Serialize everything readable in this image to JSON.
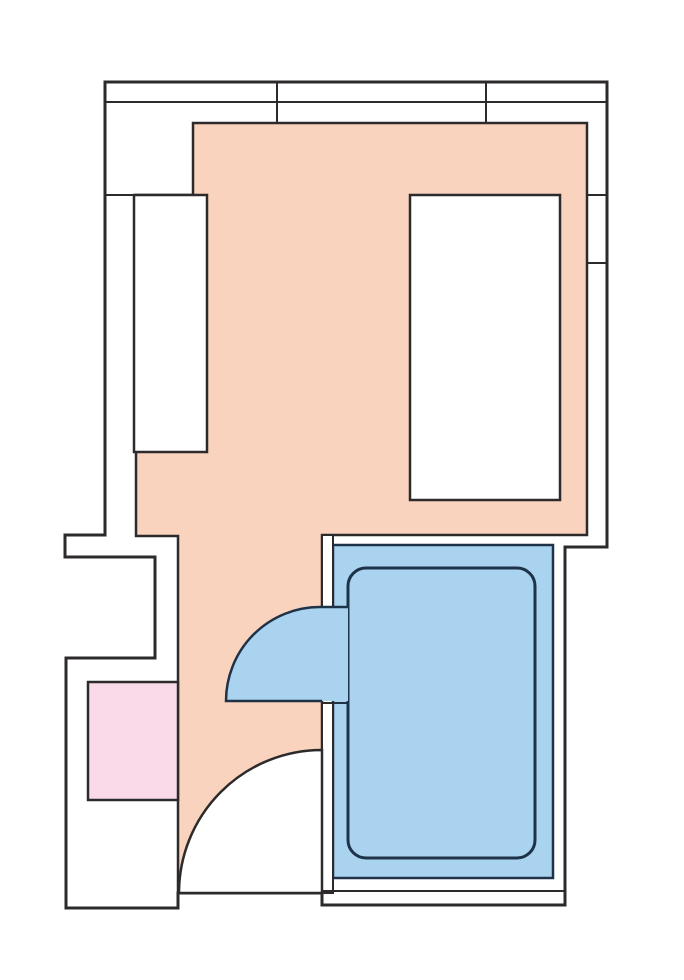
{
  "canvas": {
    "width": 684,
    "height": 980,
    "background": "#ffffff"
  },
  "palette": {
    "wall_line": "#2d2a2b",
    "fixture_line": "#1e3248",
    "floor_peach": "#f9d3bd",
    "bath_blue": "#aad3f0",
    "mat_pink": "#fad9e9",
    "white": "#ffffff"
  },
  "floorplan": {
    "description": "apartment-room-floor-plan",
    "elements": [
      {
        "name": "plan-exterior-outline",
        "kind": "path",
        "d": "M105,82 H607 V547 H565 V905 H322 V893 H178 V908 H66 V658 H155 V557 H65 V535 H105 Z",
        "fill": "white",
        "stroke": "wall_line",
        "sw": 3
      },
      {
        "name": "main-room-floor",
        "kind": "path",
        "d": "M193,123 H587 V535 H322 V893 H178 V536 H136 V195 H193 Z",
        "fill": "floor_peach",
        "stroke": "wall_line",
        "sw": 2.5
      },
      {
        "name": "window-band-inner-line",
        "kind": "path",
        "d": "M105,102 H607",
        "fill": "none",
        "stroke": "wall_line",
        "sw": 2
      },
      {
        "name": "window-mullion-left",
        "kind": "path",
        "d": "M277,82 V123",
        "fill": "none",
        "stroke": "wall_line",
        "sw": 2
      },
      {
        "name": "window-mullion-right",
        "kind": "path",
        "d": "M486,82 V123",
        "fill": "none",
        "stroke": "wall_line",
        "sw": 2
      },
      {
        "name": "right-wall-division-upper",
        "kind": "path",
        "d": "M587,195 H607",
        "fill": "none",
        "stroke": "wall_line",
        "sw": 2
      },
      {
        "name": "right-wall-division-lower",
        "kind": "path",
        "d": "M587,263 H607",
        "fill": "none",
        "stroke": "wall_line",
        "sw": 2
      },
      {
        "name": "left-wall-ledge-line",
        "kind": "path",
        "d": "M105,195 H134",
        "fill": "none",
        "stroke": "wall_line",
        "sw": 2
      },
      {
        "name": "closet-left",
        "kind": "rect",
        "x": 134,
        "y": 195,
        "w": 73,
        "h": 257,
        "fill": "white",
        "stroke": "wall_line",
        "sw": 2.5
      },
      {
        "name": "bed-right",
        "kind": "rect",
        "x": 410,
        "y": 195,
        "w": 150,
        "h": 305,
        "fill": "white",
        "stroke": "wall_line",
        "sw": 2.5
      },
      {
        "name": "pink-mat",
        "kind": "rect",
        "x": 88,
        "y": 682,
        "w": 90,
        "h": 118,
        "fill": "mat_pink",
        "stroke": "wall_line",
        "sw": 2.5
      },
      {
        "name": "bath-area-floor",
        "kind": "rect",
        "x": 333,
        "y": 545,
        "w": 220,
        "h": 333,
        "fill": "bath_blue",
        "stroke": "fixture_line",
        "sw": 2.5
      },
      {
        "name": "bathtub",
        "kind": "rect",
        "x": 348,
        "y": 568,
        "w": 187,
        "h": 290,
        "rx": 18,
        "fill": "none",
        "stroke": "fixture_line",
        "sw": 3
      },
      {
        "name": "bath-wall-upper-segment",
        "kind": "rect",
        "x": 322,
        "y": 535,
        "w": 11,
        "h": 72,
        "fill": "white",
        "stroke": "wall_line",
        "sw": 2
      },
      {
        "name": "bath-wall-lower-segment",
        "kind": "rect",
        "x": 322,
        "y": 703,
        "w": 11,
        "h": 190,
        "fill": "white",
        "stroke": "wall_line",
        "sw": 2
      },
      {
        "name": "bath-bottom-wall-inner-line",
        "kind": "path",
        "d": "M322,891 H565",
        "fill": "none",
        "stroke": "wall_line",
        "sw": 2
      },
      {
        "name": "entry-door-swing",
        "kind": "path",
        "d": "M179,893 A143,143 0 0 1 322,750 V893 Z",
        "fill": "white",
        "stroke": "wall_line",
        "sw": 2.5
      },
      {
        "name": "bath-door-swing",
        "kind": "path",
        "d": "M226,701 A94,94 0 0 1 320,607 H348 V701 Z",
        "fill": "bath_blue",
        "stroke": "none"
      },
      {
        "name": "bath-door-swing-outline",
        "kind": "path",
        "d": "M348,607 H320 A94,94 0 0 0 226,701 H322",
        "fill": "none",
        "stroke": "fixture_line",
        "sw": 2.5
      },
      {
        "name": "bath-doorway-sill-line",
        "kind": "path",
        "d": "M333,703 H348",
        "fill": "none",
        "stroke": "fixture_line",
        "sw": 2
      }
    ]
  }
}
